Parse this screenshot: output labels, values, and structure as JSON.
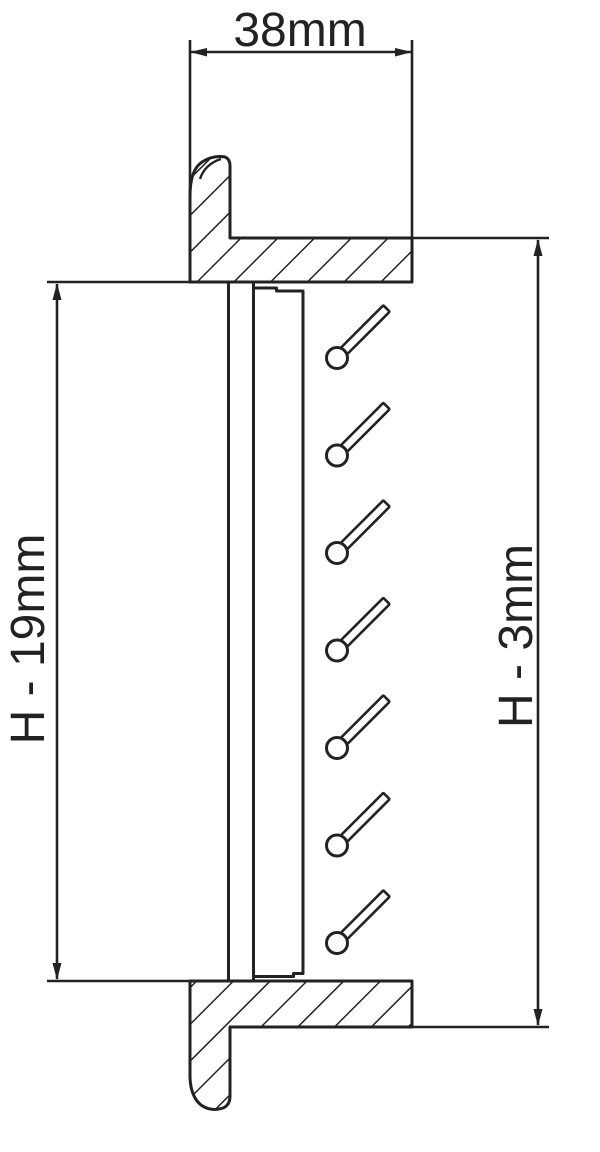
{
  "drawing": {
    "background": "#ffffff",
    "line_color": "#222222",
    "dimensions": {
      "width": {
        "label": "38mm"
      },
      "inner_height": {
        "label": "H - 19mm"
      },
      "overall_height": {
        "label": "H - 3mm"
      }
    },
    "slat_count": 7
  }
}
